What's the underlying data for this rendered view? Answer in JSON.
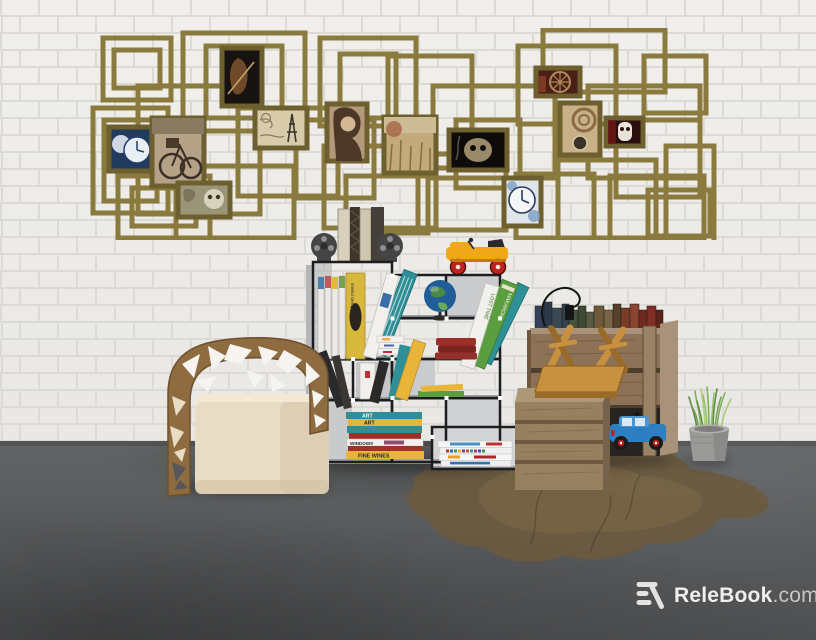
{
  "watermark": {
    "brand": "ReleBook",
    "suffix": ".com",
    "logo": "relebook-r-mark"
  },
  "scene": {
    "setting": "3d render of a reading corner: white brick wall, gray concrete floor with brown stain",
    "objects": [
      "gold-frame-wall-collage",
      "film-reel-bookends-with-books",
      "yellow-toy-car",
      "cube-bookshelf",
      "globe",
      "wooden-cutout-armchair",
      "cream-cushion",
      "leaning-books",
      "book-stacks",
      "vintage-book-crate",
      "pendant-lamp-cord",
      "upside-down-wooden-stool",
      "wooden-slat-box",
      "blue-toy-car",
      "potted-grass-plant",
      "floor-stain"
    ]
  },
  "wall_art": {
    "photos": [
      "moon-clock",
      "bicycle",
      "grim-figure",
      "skull-etching",
      "paris-map-eiffel",
      "woman-portrait",
      "wheat-field",
      "dark-skull",
      "wagon-wheel",
      "rope-compass",
      "punisher-skull",
      "blue-wall-clock"
    ]
  },
  "books": {
    "stack_top_label": "ART",
    "stack_second_label": "ART",
    "stack_windows_label": "WINDOWS",
    "stack_bottom_label": "FINE WINES",
    "lean_white_label": "LOST TIME",
    "lean_green_label": "MAKARONI",
    "design_book_label": "Interior Design"
  },
  "colors": {
    "wall": "#f5f4f1",
    "mortar": "#dcdad5",
    "floor": "#595b5d",
    "stain": "#6b5a3e",
    "stain_light": "#7d6a49",
    "stain_dark": "#4a3f2c",
    "frame_gold": "#8a7a3e",
    "frame_dark": "#6d5f2e",
    "shelf_line": "#1d1d1f",
    "shelf_panel": "#9fa2a5",
    "shelf_panel_light": "#c9cbcd",
    "reel_dark": "#454547",
    "cushion": "#e9dcc4",
    "cushion_shade": "#d6c5a8",
    "chair_wood": "#8f6b40",
    "chair_wood_dark": "#6d4f2e",
    "crate_wood": "#8d7258",
    "crate_wood_light": "#a8937a",
    "crate_wood_dark": "#6e563f",
    "box_wood": "#97805f",
    "box_wood_dark": "#75624a",
    "stool_wood": "#c8913f",
    "stool_wood_dark": "#9a6a28",
    "car_yellow": "#f0a818",
    "car_blue": "#2d7fc1",
    "wheel_red": "#c0221c",
    "plant_green": "#7fb05a",
    "pot_gray": "#9a9a98",
    "book_teal": "#2e8f96",
    "book_yellow": "#e8b53a",
    "book_red": "#9e2f28",
    "book_white": "#f2f0ec",
    "book_green": "#5a9e3f",
    "book_navy": "#33415a",
    "globe_blue": "#1f5e96",
    "globe_land": "#4a8a46",
    "text_dark": "#2a2a2a",
    "watermark_bright": "#efefef",
    "watermark_dim": "#c6c6c6"
  }
}
